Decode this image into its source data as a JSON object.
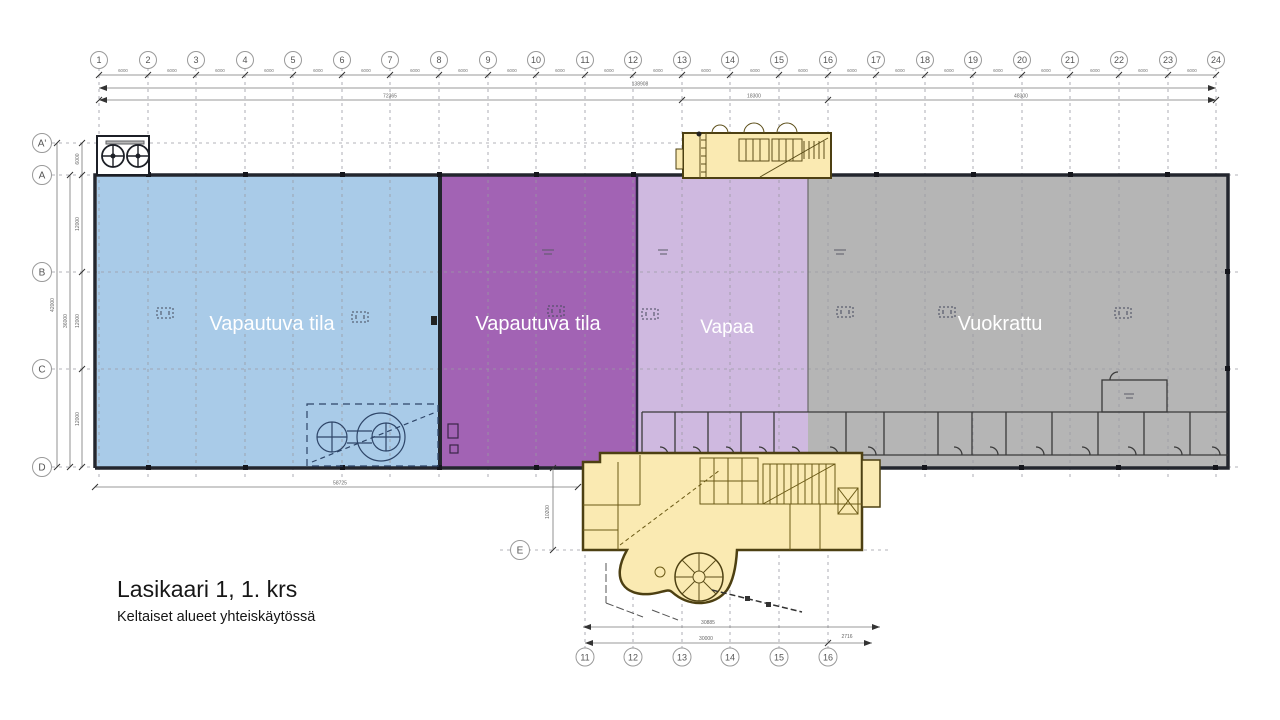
{
  "title": {
    "heading": "Lasikaari 1, 1. krs",
    "subheading": "Keltaiset alueet yhteiskäytössä"
  },
  "areas": {
    "releasing_blue": "Vapautuva tila",
    "releasing_purple": "Vapautuva tila",
    "free": "Vapaa",
    "rented": "Vuokrattu"
  },
  "grid": {
    "columns": [
      "1",
      "2",
      "3",
      "4",
      "5",
      "6",
      "7",
      "8",
      "9",
      "10",
      "11",
      "12",
      "13",
      "14",
      "15",
      "16",
      "17",
      "18",
      "19",
      "20",
      "21",
      "22",
      "23",
      "24"
    ],
    "rows": [
      "A'",
      "A",
      "B",
      "C",
      "D",
      "E"
    ],
    "bottom_columns": [
      "11",
      "12",
      "13",
      "14",
      "15",
      "16"
    ]
  },
  "dimensions": {
    "bay": "6000",
    "total_width": "138908",
    "left_total": "72365",
    "mid_total": "18300",
    "right_total": "48300",
    "row_aprime_a": "6000",
    "row_spacing": "12000",
    "a_to_d": "36000",
    "overall_depth": "42000",
    "bottom_left": "58725",
    "d_to_e": "10200",
    "entrance_width": "30885",
    "entrance_grid": "30000",
    "entrance_extra": "2716"
  },
  "colors": {
    "releasing_blue": "#a9cbe8",
    "releasing_purple": "#a263b4",
    "free_lavender": "#cfb9e0",
    "rented_gray": "#b5b5b5",
    "common_yellow": "#faeab2",
    "outline_dark": "#23262e"
  }
}
